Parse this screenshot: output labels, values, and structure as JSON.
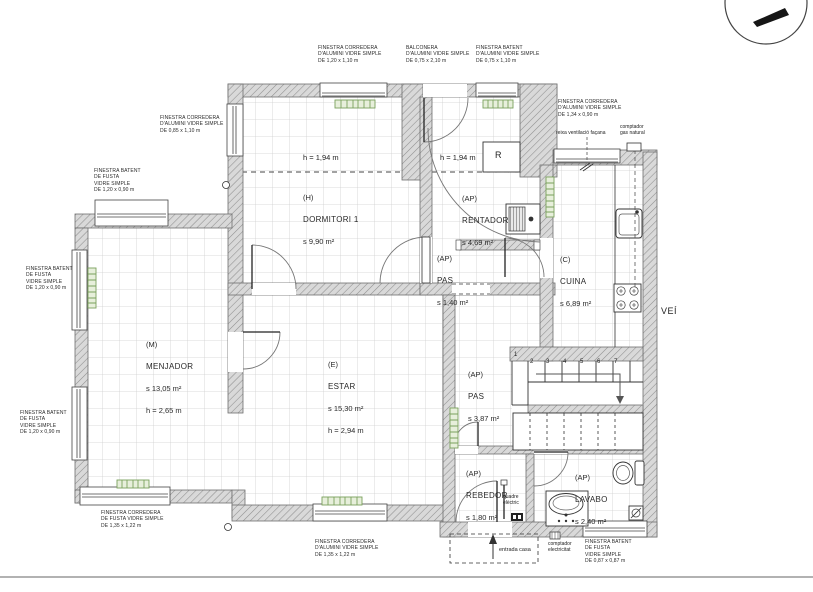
{
  "rooms": [
    {
      "id": "dormitori",
      "code": "(H)",
      "name": "DORMITORI 1",
      "area": "s  9,90 m²"
    },
    {
      "id": "rentador",
      "code": "(AP)",
      "name": "RENTADOR",
      "area": "s  4,69 m²"
    },
    {
      "id": "pas_upper",
      "code": "(AP)",
      "name": "PAS",
      "area": "s  1,40 m²"
    },
    {
      "id": "cuina",
      "code": "(C)",
      "name": "CUINA",
      "area": "s 6,89 m²"
    },
    {
      "id": "menjador",
      "code": "(M)",
      "name": "MENJADOR",
      "area": "s 13,05 m²",
      "height": "h = 2,65 m"
    },
    {
      "id": "estar",
      "code": "(E)",
      "name": "ESTAR",
      "area": "s  15,30 m²",
      "height": "h = 2,94 m"
    },
    {
      "id": "pas_lower",
      "code": "(AP)",
      "name": "PAS",
      "area": "s  3,87 m²"
    },
    {
      "id": "rebedor",
      "code": "(AP)",
      "name": "REBEDOR",
      "area": "s  1,80 m²"
    },
    {
      "id": "lavabo",
      "code": "(AP)",
      "name": "LAVABO",
      "area": "s  2,40 m²"
    }
  ],
  "heights": {
    "dormitori_zone": "h = 1,94 m",
    "rentador_zone": "h = 1,94 m"
  },
  "windows": [
    {
      "id": "w1",
      "label": "FINESTRA CORREDERA\nD'ALUMINI VIDRE SIMPLE\nDE  1,20  x 1,10 m"
    },
    {
      "id": "w2",
      "label": "BALCONERA\nD'ALUMINI VIDRE SIMPLE\nDE  0,75  x 2,10 m"
    },
    {
      "id": "w3",
      "label": "FINESTRA BATENT\nD'ALUMINI VIDRE SIMPLE\nDE  0,75  x 1,10 m"
    },
    {
      "id": "w4",
      "label": "FINESTRA CORREDERA\nD'ALUMINI VIDRE SIMPLE\nDE  1,34  x 0,90 m"
    },
    {
      "id": "w5",
      "label": "FINESTRA CORREDERA\nD'ALUMINI VIDRE SIMPLE\nDE  0,85  x 1,10 m"
    },
    {
      "id": "w6",
      "label": "FINESTRA BATENT\nDE FUSTA\nVIDRE SIMPLE\nDE  1,20  x 0,90 m"
    },
    {
      "id": "w7",
      "label": "FINESTRA BATENT\nDE FUSTA\nVIDRE SIMPLE\nDE  1,20  x 0,90 m"
    },
    {
      "id": "w8",
      "label": "FINESTRA BATENT\nDE FUSTA\nVIDRE SIMPLE\nDE  1,20  x 0,90 m"
    },
    {
      "id": "w9",
      "label": "FINESTRA CORREDERA\nDE FUSTA VIDRE SIMPLE\nDE  1,35 x 1,22 m"
    },
    {
      "id": "w10",
      "label": "FINESTRA CORREDERA\nD'ALUMINI VIDRE SIMPLE\nDE  1,35 x 1,22 m"
    },
    {
      "id": "w11",
      "label": "FINESTRA BATENT\nDE FUSTA\nVIDRE SIMPLE\nDE  0,87 x 0,87 m"
    }
  ],
  "annotations": {
    "reixa_ventilacio": "reixa ventilació façana",
    "comptador_gas": "comptador\ngas natural",
    "comptador_electricitat": "comptador\nelectricitat",
    "entrada_casa": "entrada casa",
    "quadre_electric": "quadre\nelèctric",
    "vei": "VEÍ",
    "closet": "R"
  },
  "stairs": {
    "steps": [
      "1",
      "2",
      "3",
      "4",
      "5",
      "6",
      "7"
    ]
  },
  "colors": {
    "radiator_fill": "#e7efdb",
    "radiator_stroke": "#7aa05c",
    "wall_hatch": "#8f8f8f",
    "tile_grid": "#cfcfcf"
  }
}
